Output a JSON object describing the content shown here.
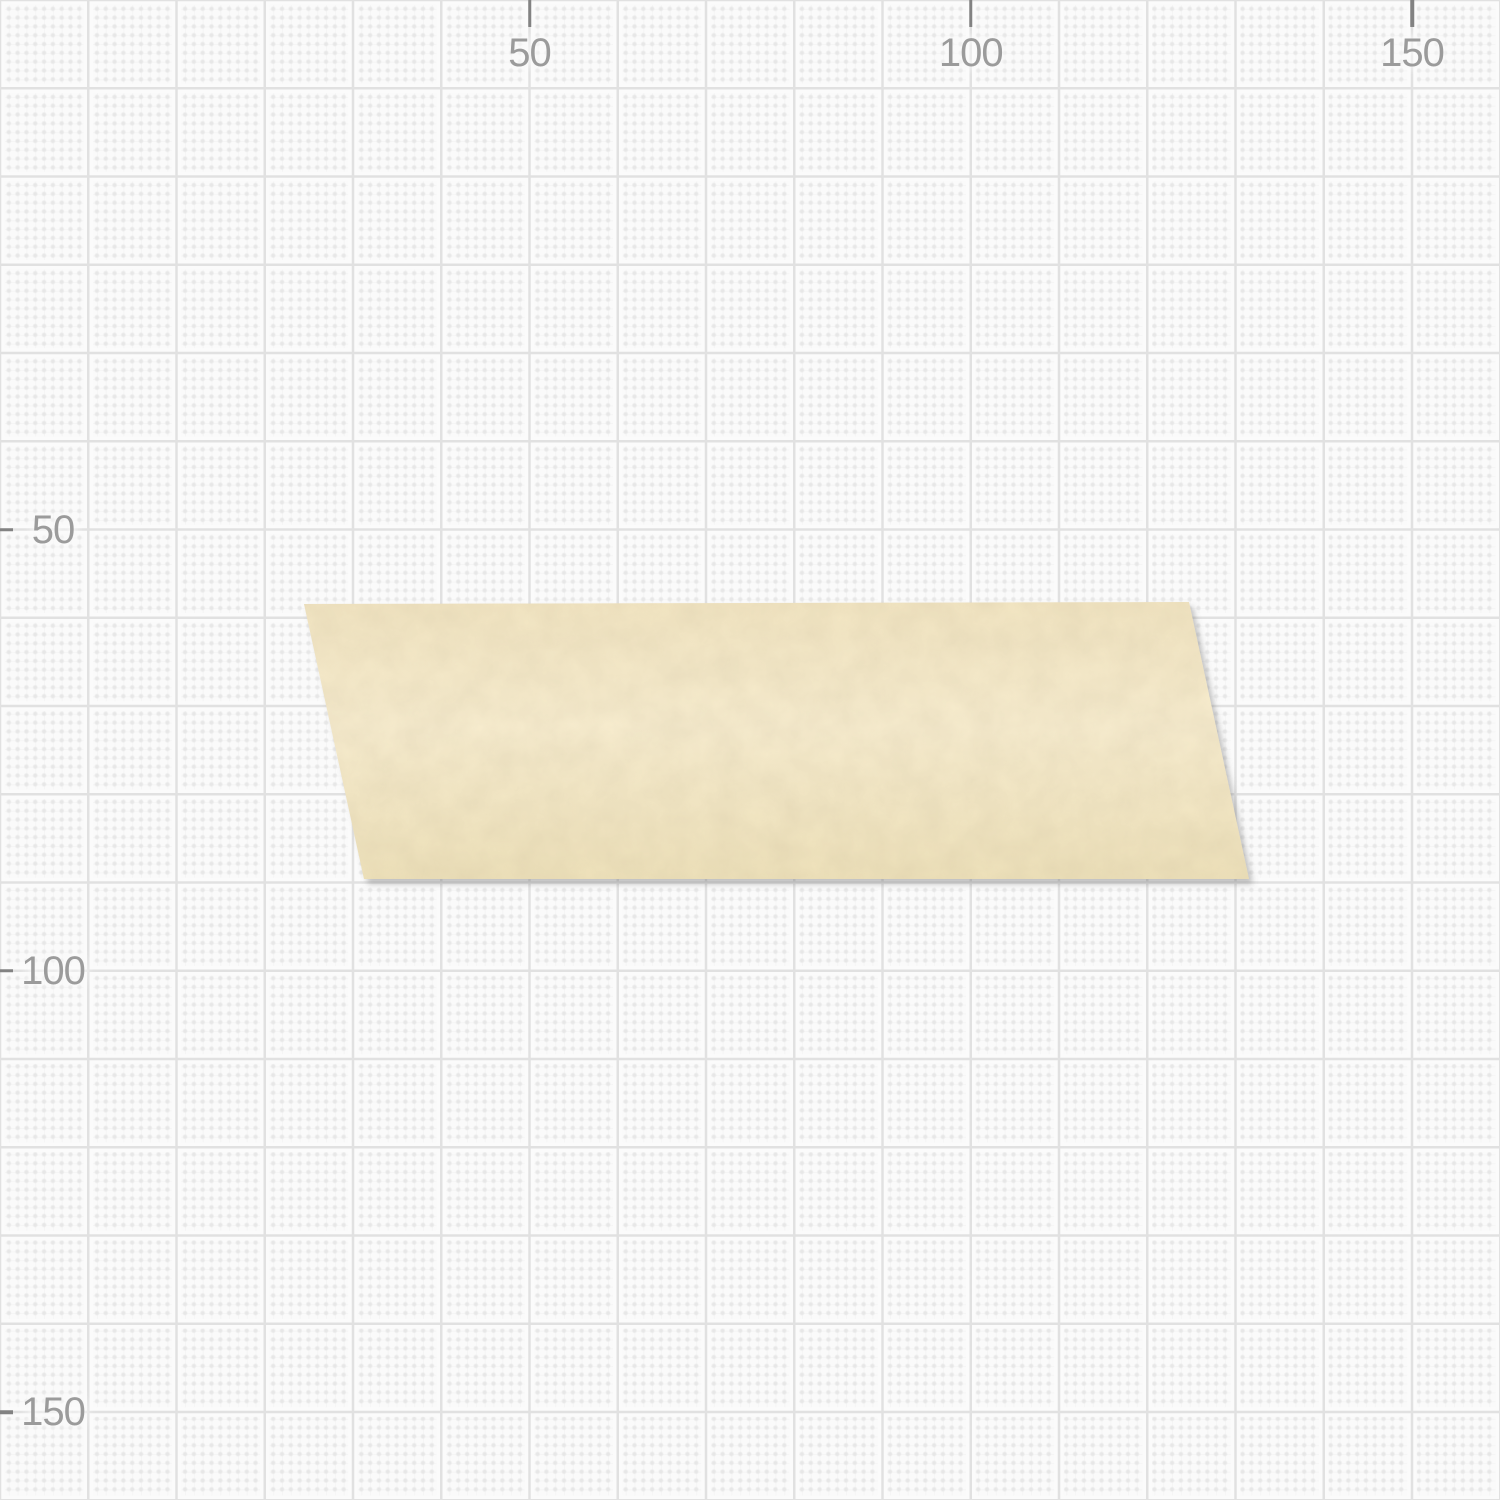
{
  "canvas": {
    "background_color": "#fafafa",
    "grid": {
      "minor_spacing_px": 8.825,
      "major_spacing_px": 88.25,
      "dot_color": "#e7e7e7",
      "major_line_color": "#e1e1e1",
      "units_between_labels": 50
    },
    "rulers": {
      "tick_color": "#828282",
      "label_color": "#9b9b9b",
      "top": {
        "ticks": [
          {
            "label": "50",
            "x": 529.5
          },
          {
            "label": "100",
            "x": 970.75
          },
          {
            "label": "150",
            "x": 1412
          }
        ]
      },
      "left": {
        "ticks": [
          {
            "label": "50",
            "y": 529.5
          },
          {
            "label": "100",
            "y": 970.75
          },
          {
            "label": "150",
            "y": 1412
          }
        ]
      }
    },
    "objects": [
      {
        "name": "tape-strip",
        "shape": "parallelogram",
        "points": "304,604 1189,602 1249,879 364,879",
        "fill_top": "#f2e5c2",
        "fill_middle": "#f7ecce",
        "fill_bottom": "#eee1ba",
        "grain_color": "#6b5a3a",
        "shadow_color": "#737373"
      }
    ]
  }
}
